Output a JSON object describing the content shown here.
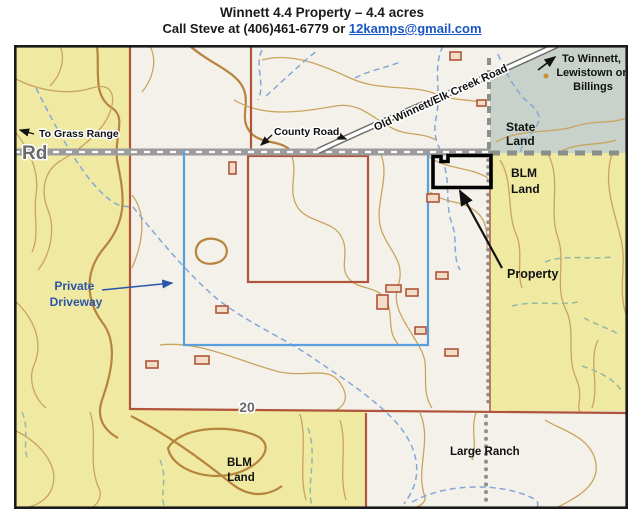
{
  "header": {
    "title": "Winnett 4.4 Property – 4.4 acres",
    "contact_prefix": "Call Steve at (406)461-6779 or ",
    "email": "12kamps@gmail.com"
  },
  "map": {
    "labels": {
      "rd": "Rd",
      "to_grass_range": "To Grass Range",
      "county_road": "County Road",
      "old_road": "Old Winnett/Elk Creek Road",
      "to_winnett_1": "To Winnett,",
      "to_winnett_2": "Lewistown or",
      "to_winnett_3": "Billings",
      "state_land_1": "State",
      "state_land_2": "Land",
      "blm_right_1": "BLM",
      "blm_right_2": "Land",
      "blm_bottom_1": "BLM",
      "blm_bottom_2": "Land",
      "property": "Property",
      "private_driveway_1": "Private",
      "private_driveway_2": "Driveway",
      "large_ranch": "Large Ranch",
      "route_number": "20"
    },
    "colors": {
      "blm_land": "#f0e9a2",
      "state_land": "#c8d1ca",
      "private_land": "#f4f1ea",
      "map_border": "#1a1a1a",
      "property_outline": "#000000",
      "driveway_line": "#58a0dc",
      "driveway_text": "#2b55a8",
      "section_line": "#b0543a",
      "contour": "#c9a45c",
      "contour_index": "#b6843c",
      "stream": "#84a7d6",
      "stream_green": "#93b9a4",
      "road_fill": "#9c9c9c",
      "boundary_dash": "#8a8f8c",
      "building": "#b0543a",
      "link": "#1a56c4"
    }
  }
}
